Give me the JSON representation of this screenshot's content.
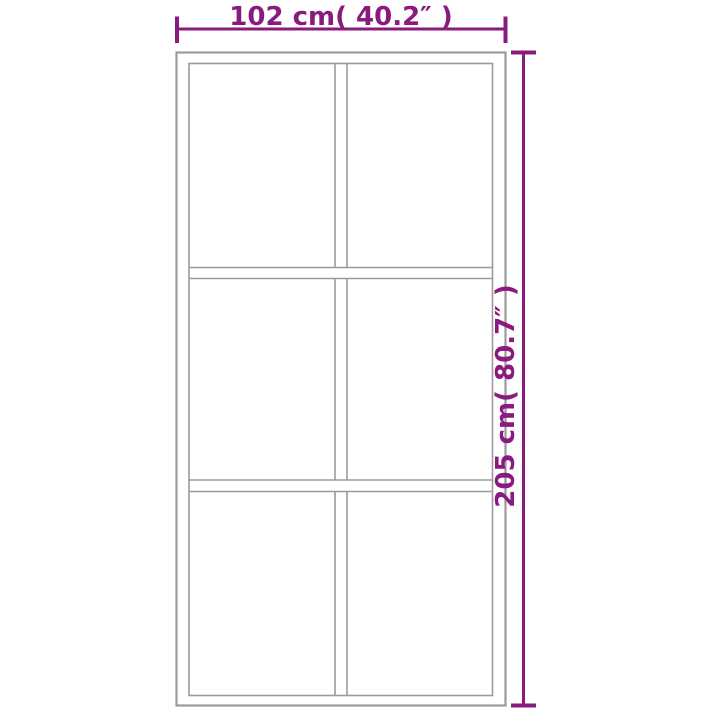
{
  "diagram": {
    "title": "Sliding door dimension diagram",
    "door": {
      "panel_rows": 3,
      "panel_columns": 2,
      "panel_count": 6
    },
    "colors": {
      "dimension": "#8B1A7E",
      "outline": "#9B9B9B",
      "background": "#FFFFFF"
    }
  },
  "dimensions": {
    "width": {
      "label": "102 cm( 40.2″ )",
      "value_cm": 102,
      "value_inch": 40.2
    },
    "height": {
      "label": "205 cm( 80.7″ )",
      "value_cm": 205,
      "value_inch": 80.7
    }
  }
}
